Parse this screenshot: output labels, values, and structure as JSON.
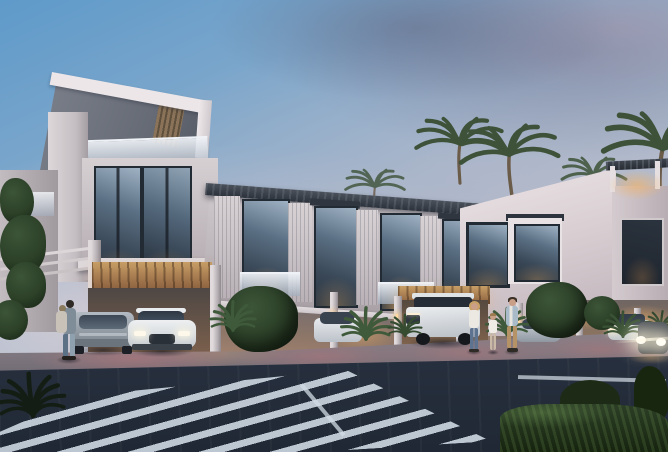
{
  "scene": {
    "type": "architectural rendering",
    "description": "Dusk exterior rendering of a modern white townhouse row: lit interiors, covered carports with parked cars, palm trees, pedestrians and a striped crosswalk in the foreground",
    "time_of_day": "dusk",
    "weather": "partly cloudy pink-tinged sky"
  },
  "palette": {
    "sky_blue": "#5e9aca",
    "sky_haze": "#b3bccc",
    "cloud_slate": "#6c7090",
    "cloud_pink": "#d9b3bc",
    "horizon_pink": "#e6d2d6",
    "facade_white": "#e9e2e4",
    "facade_shadow": "#b7aeb3",
    "panel_gray": "#70757f",
    "roof_charcoal": "#2c323b",
    "glass_cool": "#46566a",
    "glass_dark": "#2b3642",
    "interior_warm": "#f2a85c",
    "carport_wood": "#caa06a",
    "pavement_rose": "#a57f86",
    "sidewalk_gray": "#7d757d",
    "road_asphalt": "#2a3342",
    "marking_white": "#cdd8e2",
    "foliage_dark": "#243522",
    "palm_green": "#3d5238",
    "hedge_green": "#1c2a16"
  },
  "buildings": {
    "left_tower": {
      "label": "three-storey corner unit with angled white roof fascia, pergola slats and bronze louver accent"
    },
    "townhouse_row": {
      "label": "two-storey townhouse row with dark slatted roof, louvered panels and glazed facades"
    },
    "right_block": {
      "label": "white end block with sloped parapet and rooftop pergola terrace"
    }
  },
  "vehicles": {
    "gray_suv": {
      "label": "grey SUV parked in carport",
      "color": "#8f98a2"
    },
    "white_crossover": {
      "label": "white crossover facing street",
      "color": "#e6e9ec"
    },
    "white_partial": {
      "label": "white car behind palm bush",
      "color": "#dfe3e6"
    },
    "white_truck": {
      "label": "white off-road pickup in carport",
      "color": "#dfe3e6"
    },
    "silver_car": {
      "label": "silver car parked at right",
      "color": "#b6bcc3"
    },
    "white_suv": {
      "label": "white SUV parked far right",
      "color": "#e3e6ea"
    },
    "glare_car": {
      "label": "car with headlights on at right edge",
      "color": "#3a4047"
    }
  },
  "people": {
    "couple": {
      "label": "couple standing beside grey SUV"
    },
    "woman": {
      "label": "woman walking on sidewalk"
    },
    "child": {
      "label": "child walking between adults"
    },
    "man": {
      "label": "man walking on sidewalk"
    }
  },
  "vegetation": {
    "tall_palms": 6,
    "fan_palm_bushes": 7,
    "round_trees": 3,
    "hedge": {
      "label": "dark hedge in foreground right"
    }
  },
  "road": {
    "crosswalk": {
      "label": "diagonal striped pedestrian crossing"
    },
    "stop_line": {
      "label": "white transverse stop line"
    },
    "edge_line": {
      "label": "white diagonal edge marking"
    }
  },
  "lighting": {
    "interior_windows": "warm amber",
    "carport_ceilings": "warm downlights",
    "pavement_wash": "rose-pink uplights"
  }
}
